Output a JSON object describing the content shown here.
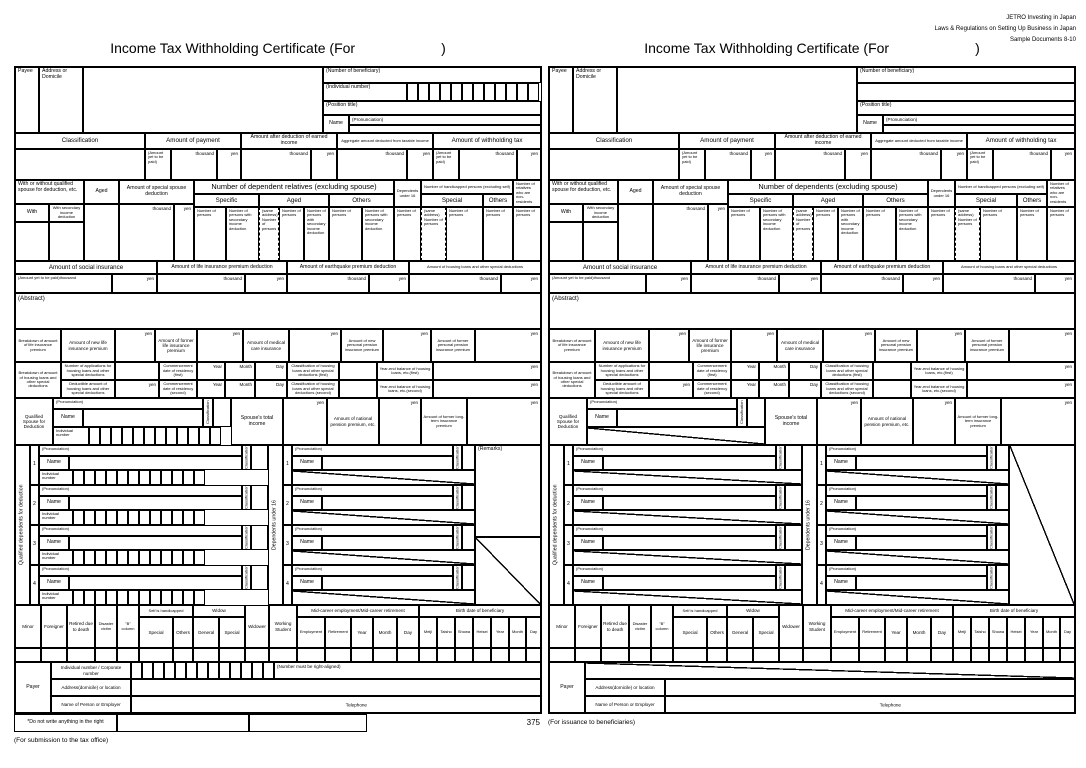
{
  "colors": {
    "ink": "#000000",
    "paper": "#ffffff"
  },
  "jetro": {
    "line1": "JETRO Investing in Japan",
    "line2": "Laws & Regulations on Setting Up Business in Japan",
    "line3": "Sample Documents 8-10"
  },
  "title": {
    "text": "Income Tax Withholding Certificate  (For",
    "close": ")"
  },
  "payee": {
    "payee": "Payee",
    "address": "Address or Domicile",
    "beneficiary": "(Number of beneficiary)",
    "individual": "(Individual number)",
    "position": "(Position title)",
    "name": "Name",
    "pron": "(Pronunciation)"
  },
  "cls": {
    "classification": "Classification",
    "payment": "Amount of payment",
    "after": "Amount after deduction of earned income",
    "aggregate": "Aggregate amount deducted from taxable income",
    "withholding": "Amount of withholding tax",
    "yet": "(Amount yet to be paid)",
    "thousand": "thousand",
    "yen": "yen"
  },
  "dep": {
    "spouse_hdr": "With or without qualified spouse for deduction, etc.",
    "with": "With",
    "with_sec": "With secondary income deduction",
    "aged": "Aged",
    "special_spouse": "Amount of special spouse deduction",
    "specific": "Specific",
    "others": "Others",
    "special": "Special",
    "u16": "Dependents under 16",
    "handicapped": "Number of handicapped persons (excluding self)",
    "nonresident": "Number of relatives who are non-residents",
    "nop": "Number of persons",
    "nop_sec": "Number of persons with secondary income deduction",
    "same_addr": "(same address) Number of persons"
  },
  "soc": {
    "social": "Amount of social insurance",
    "yet_thousand": "(Amount yet to be paid)thousand",
    "life": "Amount of life insurance premium deduction",
    "quake": "Amount of earthquake premium deduction",
    "housing": "Amount of housing loans and other special deductions",
    "abstract": "(Abstract)"
  },
  "life": {
    "breakdown": "Breakdown of amount of life insurance premium",
    "n": "Amount of new life insurance premium",
    "f": "Amount of former life insurance premium",
    "m": "Amount of medical care insurance",
    "np": "Amount of new personal pension insurance premium",
    "fp": "Amount of former personal pension insurance premium"
  },
  "loan": {
    "breakdown": "Breakdown of amount of housing loans and other special deductions",
    "apps": "Number of applications for housing loans and other special deductions",
    "ded": "Deductible amount of housing loans and other special deductions",
    "c1": "Commencement date of residency (first)",
    "c2": "Commencement date of residency (second)",
    "k1": "Classification of housing loans and other special deductions (first)",
    "k2": "Classification of housing loans and other special deductions (second)",
    "b1": "Year-end balance of housing loans, etc.(first)",
    "b2": "Year-end balance of housing loans, etc.(second)",
    "year": "Year",
    "month": "Month",
    "day": "Day"
  },
  "sp": {
    "label": "Qualified Spouse for Deduction",
    "pron": "(Pronunciation)",
    "name": "Name",
    "ind": "Individual number",
    "cls": "Classification",
    "total": "Spouse's total income",
    "pension": "Amount of national pension premium, etc.",
    "longterm": "Amount of former long-term insurance premium"
  },
  "deps": {
    "qualified": "Qualified dependents for deduction",
    "u16": "Dependents under 16",
    "cls": "Classification",
    "ind": "Individual number",
    "pron": "(Pronunciation)",
    "name": "Name",
    "remarks": "(Remarks)",
    "n1": "1",
    "n2": "2",
    "n3": "3",
    "n4": "4"
  },
  "minor": {
    "minor": "Minor",
    "foreigner": "Foreigner",
    "retired": "Retired due to death",
    "disaster": "Disaster victim",
    "b": "\"B\" column",
    "selfh": "Self is handicapped",
    "widow": "Widow",
    "widower": "Widower",
    "working": "Working Student",
    "special": "Special",
    "others": "Others",
    "general": "General",
    "mid": "Mid-career employment/Mid-career retirement",
    "emp": "Employment",
    "ret": "Retirement",
    "birth": "Birth date of beneficiary",
    "meiji": "Meiji",
    "taisho": "Taisho",
    "showa": "Showa",
    "heisei": "Heisei",
    "year": "Year",
    "month": "Month",
    "day": "Day"
  },
  "payer": {
    "label": "Payer",
    "ind": "Individual number / Corporate number",
    "right": "(Number must be right-aligned)",
    "addr": "Address(domicile) or location",
    "name": "Name of Person or Employer",
    "tel": "Telephone"
  },
  "left": {
    "dep_hdr": "Number of dependent relatives (excluding spouse)",
    "note": "*Do not write anything in the right",
    "page": "375",
    "footer": "(For submission to the tax office)"
  },
  "right": {
    "dep_hdr": "Number of dependents (excluding spouse)",
    "footer": "(For issuance to beneficiaries)"
  }
}
